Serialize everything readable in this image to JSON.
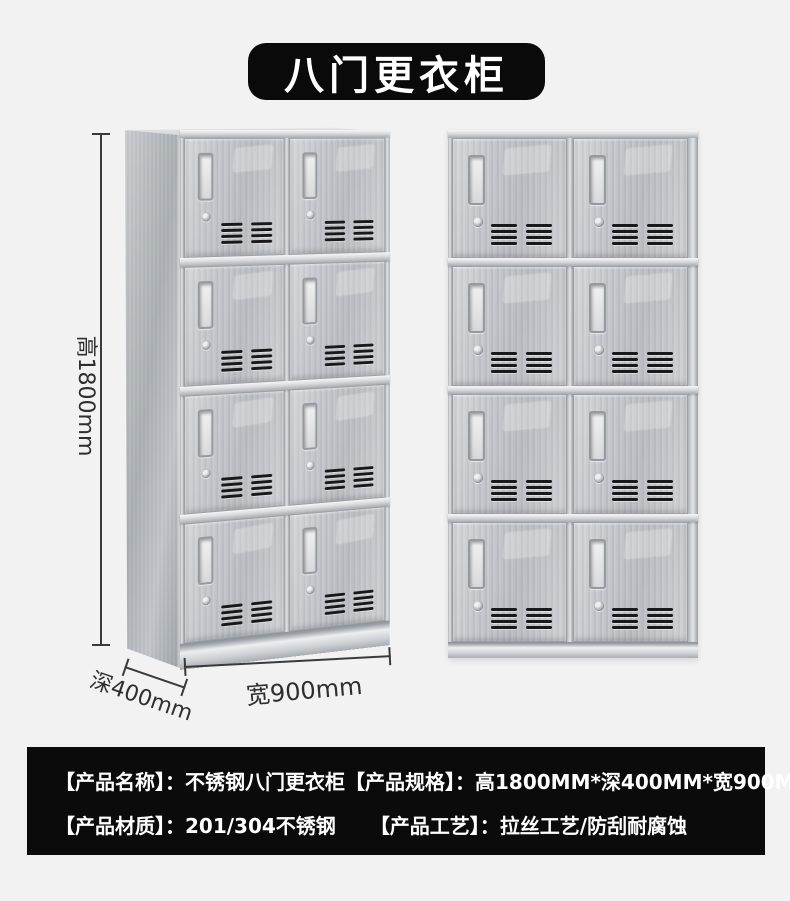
{
  "page": {
    "background_color": "#f2f2f2",
    "title": "八门更衣柜",
    "title_bg_color": "#0a0a0a",
    "title_text_color": "#ffffff"
  },
  "dimensions": {
    "height_label": "高1800mm",
    "depth_label": "深400mm",
    "width_label": "宽900mm",
    "annotation_color": "#3a3a3a"
  },
  "cabinet": {
    "rows": 4,
    "columns": 2,
    "door_count": 8,
    "views": [
      "perspective-left-view",
      "front-view"
    ],
    "finish_color": "#c0c4c8"
  },
  "info_bar": {
    "background_color": "#0b0b0b",
    "text_color": "#ffffff",
    "line1": [
      {
        "label": "【产品名称】：",
        "value": "不锈钢八门更衣柜"
      },
      {
        "label": "【产品规格】：",
        "value": "高1800MM*深400MM*宽900MM"
      }
    ],
    "line2": [
      {
        "label": "【产品材质】：",
        "value": "201/304不锈钢"
      },
      {
        "label": "【产品工艺】：",
        "value": "拉丝工艺/防刮耐腐蚀"
      }
    ]
  }
}
